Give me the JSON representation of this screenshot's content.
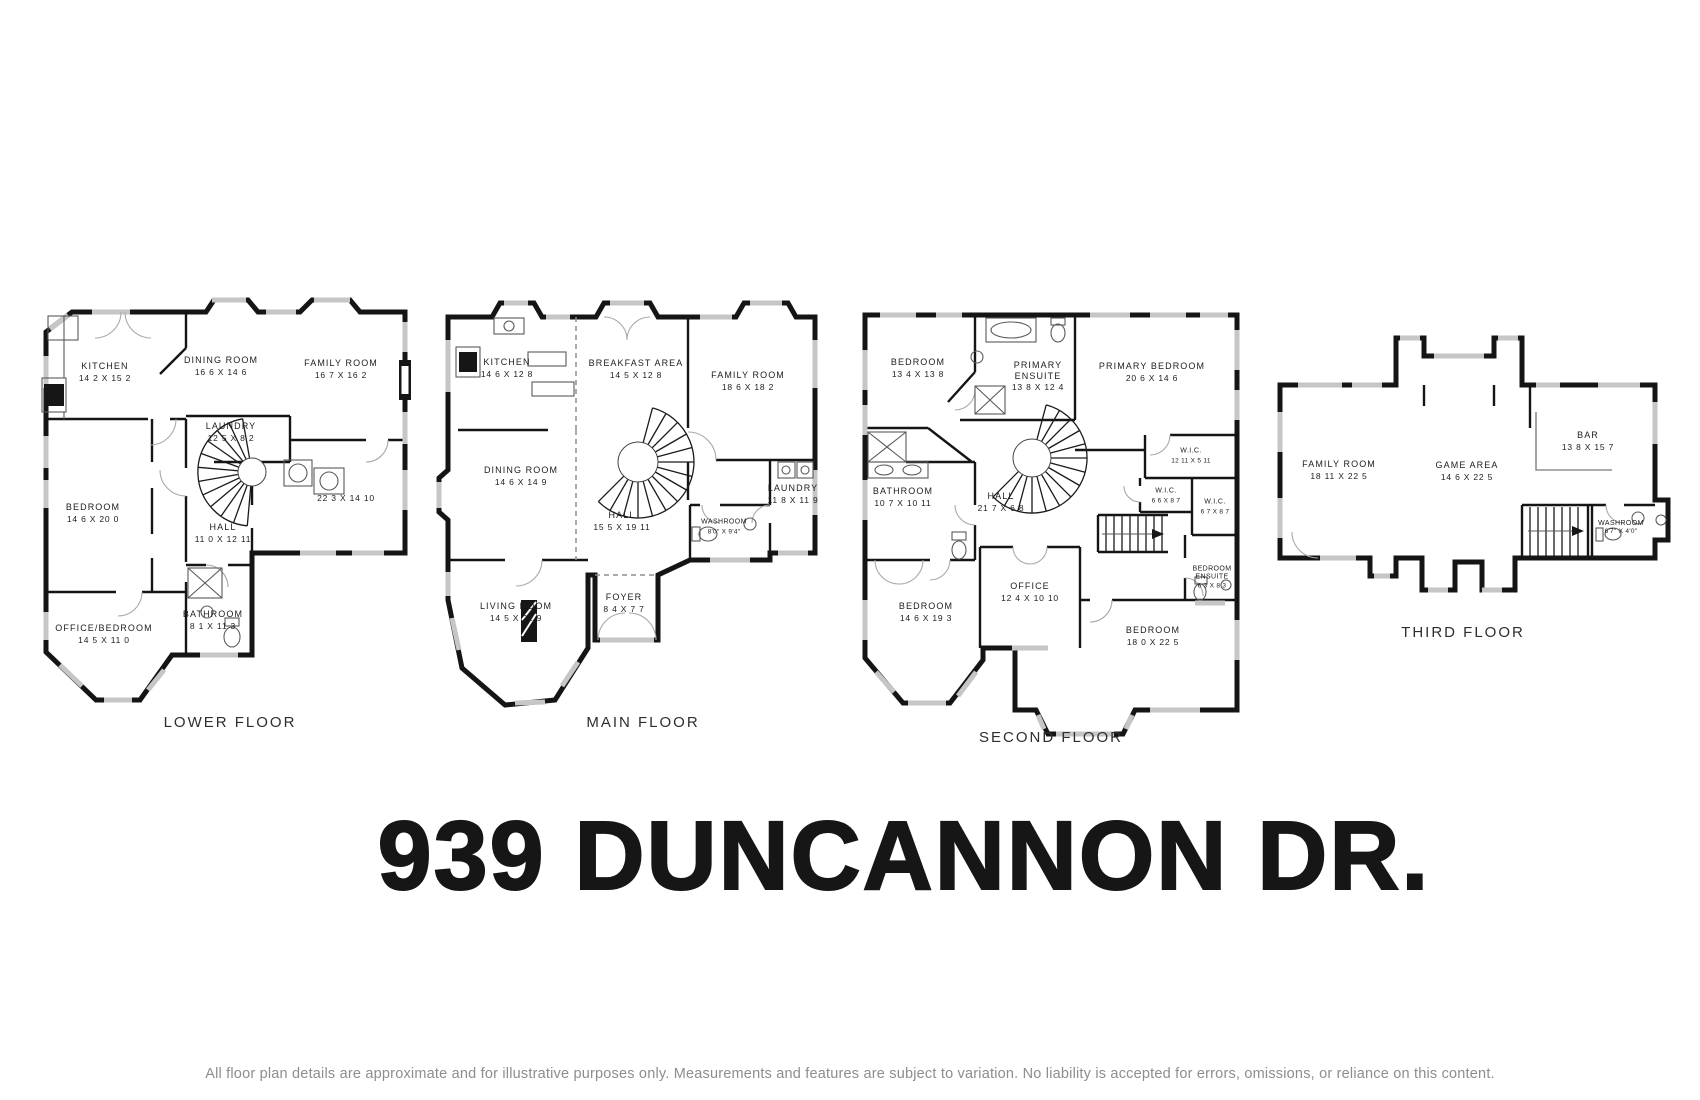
{
  "title": "939 DUNCANNON DR.",
  "disclaimer": "All floor plan details are approximate and for illustrative purposes only. Measurements and features are subject to variation. No liability is accepted for errors, omissions, or reliance on this content.",
  "palette": {
    "wall": "#151515",
    "window_gray": "#c6c6c6",
    "door_arc": "#a9a9a9",
    "label_text": "#1d1d1d",
    "caption_text": "#2e2e2e",
    "disclaimer_gray": "#8d8d8d"
  },
  "icons": {
    "spiral_staircase": "radial fan of steps",
    "staircase": "parallel treads with direction arrow",
    "toilet": "tank and bowl ellipse",
    "sink": "circle basin",
    "bathtub": "oval in rectangle",
    "stove": "black range box",
    "fireplace": "black hatched box",
    "closet": "x-crossed box"
  },
  "floors": [
    {
      "label": "LOWER FLOOR",
      "rooms": [
        {
          "name": "KITCHEN",
          "dims": "14 2 X 15 2"
        },
        {
          "name": "DINING ROOM",
          "dims": "16 6 X 14 6"
        },
        {
          "name": "FAMILY ROOM",
          "dims": "16 7 X 16 2"
        },
        {
          "name": "LAUNDRY",
          "dims": "12 5 X 8 2"
        },
        {
          "name": "",
          "dims": "22 3 X 14 10"
        },
        {
          "name": "BEDROOM",
          "dims": "14 6 X 20 0"
        },
        {
          "name": "HALL",
          "dims": "11 0 X 12 11"
        },
        {
          "name": "BATHROOM",
          "dims": "8 1 X 11 3"
        },
        {
          "name": "OFFICE/BEDROOM",
          "dims": "14 5 X 11 0"
        }
      ]
    },
    {
      "label": "MAIN FLOOR",
      "rooms": [
        {
          "name": "KITCHEN",
          "dims": "14 6 X 12 8"
        },
        {
          "name": "BREAKFAST AREA",
          "dims": "14 5 X 12 8"
        },
        {
          "name": "FAMILY ROOM",
          "dims": "18 6 X 18 2"
        },
        {
          "name": "DINING ROOM",
          "dims": "14 6 X 14 9"
        },
        {
          "name": "HALL",
          "dims": "15 5 X 19 11"
        },
        {
          "name": "WASHROOM",
          "dims": "8'0\" X 9'4\""
        },
        {
          "name": "LAUNDRY",
          "dims": "11 8 X 11 9"
        },
        {
          "name": "FOYER",
          "dims": "8 4 X 7 7"
        },
        {
          "name": "LIVING ROOM",
          "dims": "14 5 X 21 9"
        }
      ]
    },
    {
      "label": "SECOND FLOOR",
      "rooms": [
        {
          "name": "BEDROOM",
          "dims": "13 4 X 13 8"
        },
        {
          "name": "PRIMARY ENSUITE",
          "dims": "13 8 X 12 4"
        },
        {
          "name": "PRIMARY BEDROOM",
          "dims": "20 6 X 14 6"
        },
        {
          "name": "BATHROOM",
          "dims": "10 7 X 10 11"
        },
        {
          "name": "HALL",
          "dims": "21 7 X 6 8"
        },
        {
          "name": "W.I.C.",
          "dims": "12 11 X 5 11"
        },
        {
          "name": "W.I.C.",
          "dims": "6 6 X 8 7"
        },
        {
          "name": "W.I.C.",
          "dims": "6 7 X 8 7"
        },
        {
          "name": "OFFICE",
          "dims": "12 4 X 10 10"
        },
        {
          "name": "BEDROOM",
          "dims": "14 6 X 19 3"
        },
        {
          "name": "BEDROOM ENSUITE",
          "dims": "6 3 X 8 3"
        },
        {
          "name": "BEDROOM",
          "dims": "18 0 X 22 5"
        }
      ]
    },
    {
      "label": "THIRD FLOOR",
      "rooms": [
        {
          "name": "FAMILY ROOM",
          "dims": "18 11 X 22 5"
        },
        {
          "name": "GAME AREA",
          "dims": "14 6 X 22 5"
        },
        {
          "name": "BAR",
          "dims": "13 8 X 15 7"
        },
        {
          "name": "WASHROOM",
          "dims": "6'7\" X 4'0\""
        }
      ]
    }
  ]
}
